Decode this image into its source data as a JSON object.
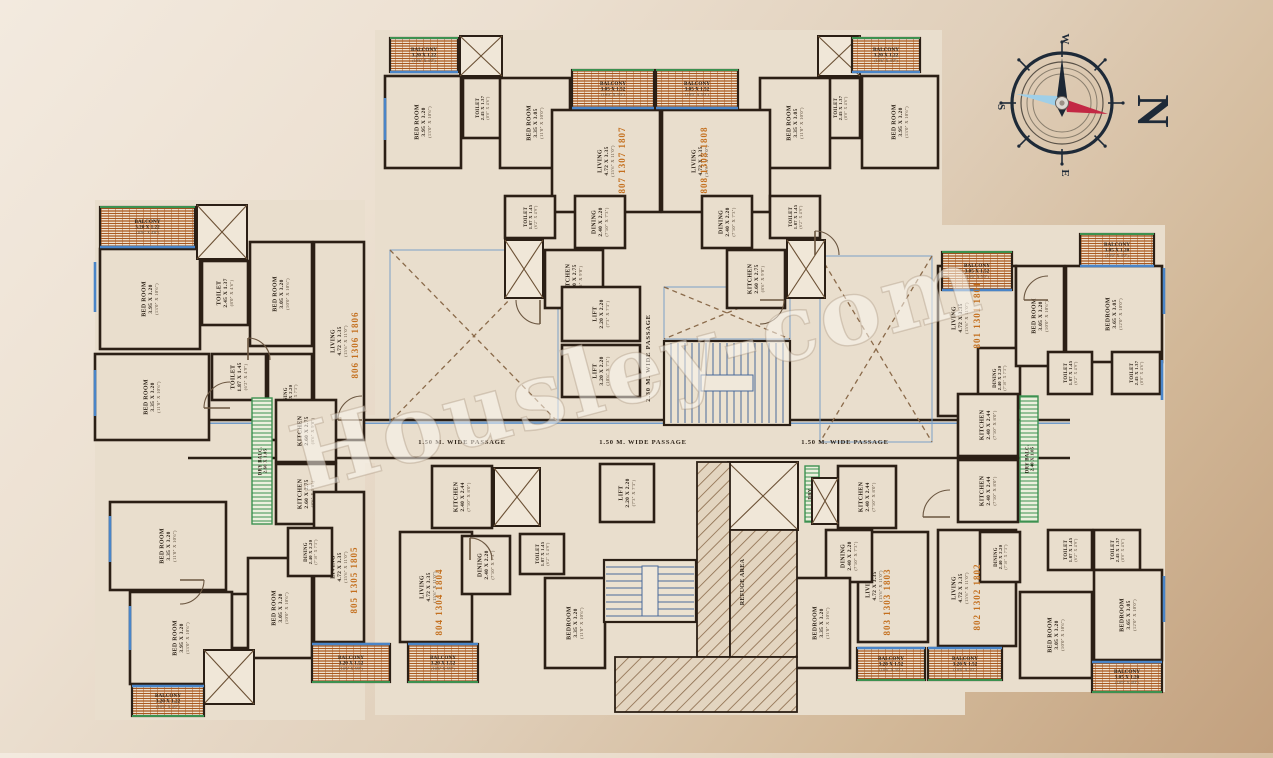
{
  "watermark": {
    "text": "Housley-com"
  },
  "compass": {
    "big_letter": "N",
    "letters": [
      {
        "t": "W",
        "x": 0,
        "y": -64
      },
      {
        "t": "S",
        "x": -64,
        "y": 4
      },
      {
        "t": "E",
        "x": 0,
        "y": 70
      }
    ],
    "colors": {
      "ring": "#1e2a38",
      "needle_dark": "#1c2734",
      "needle_red": "#c32844",
      "needle_blue": "#9fcfe8"
    }
  },
  "colors": {
    "wall": "#2b1f15",
    "interior": "#e9decd",
    "label": "#2e2318",
    "feet": "#5a4a38",
    "flat": "#c4701f",
    "window": "#4a85c8",
    "green": "#3c9150",
    "balcony_stripe": "#a9581f",
    "balcony_bg": "#f1e7d6",
    "door": "#6b5640",
    "tread": "#4a6a9a",
    "dash": "#8a6a4a"
  },
  "passages": [
    {
      "t": "1.50 M. WIDE PASSAGE",
      "x": 462,
      "y": 444,
      "rot": 0
    },
    {
      "t": "1.50 M. WIDE PASSAGE",
      "x": 643,
      "y": 444,
      "rot": 0
    },
    {
      "t": "1.50 M. WIDE PASSAGE",
      "x": 845,
      "y": 444,
      "rot": 0
    },
    {
      "t": "2.30 M. WIDE PASSAGE",
      "x": 650,
      "y": 358,
      "rot": -90
    }
  ],
  "refuge_label": {
    "t": "REFUGE AREA",
    "x": 742,
    "y": 582
  },
  "flats": [
    {
      "t": "807 1307 1807",
      "x": 625,
      "y": 160
    },
    {
      "t": "808 1308 1808",
      "x": 707,
      "y": 160
    },
    {
      "t": "806 1306 1806",
      "x": 358,
      "y": 345
    },
    {
      "t": "801 1301 1801",
      "x": 980,
      "y": 315
    },
    {
      "t": "805 1305 1805",
      "x": 357,
      "y": 580
    },
    {
      "t": "804 1304 1804",
      "x": 442,
      "y": 602
    },
    {
      "t": "803 1303 1803",
      "x": 890,
      "y": 602
    },
    {
      "t": "802 1302 1802",
      "x": 980,
      "y": 597
    }
  ],
  "silhouette": [
    [
      95,
      200,
      270,
      520
    ],
    [
      375,
      30,
      567,
      410
    ],
    [
      935,
      225,
      230,
      467
    ],
    [
      375,
      440,
      590,
      275
    ],
    [
      185,
      415,
      890,
      48
    ]
  ],
  "balconies": [
    {
      "x": 390,
      "y": 38,
      "w": 68,
      "h": 34,
      "l": [
        "BALCONY",
        "3.20 X 1.22",
        "(10'6\" X 4'0\")"
      ],
      "inner": "bottom"
    },
    {
      "x": 852,
      "y": 38,
      "w": 68,
      "h": 34,
      "l": [
        "BALCONY",
        "3.20 X 1.22",
        "(10'6\" X 4'0\")"
      ],
      "inner": "bottom"
    },
    {
      "x": 572,
      "y": 70,
      "w": 82,
      "h": 38,
      "l": [
        "BALCONY",
        "3.05 X 1.52",
        "(10'0\" X 5'0\")"
      ],
      "inner": "bottom"
    },
    {
      "x": 656,
      "y": 70,
      "w": 82,
      "h": 38,
      "l": [
        "BALCONY",
        "3.05 X 1.52",
        "(10'0\" X 5'0\")"
      ],
      "inner": "bottom"
    },
    {
      "x": 100,
      "y": 207,
      "w": 95,
      "h": 40,
      "l": [
        "BALCONY",
        "3.20 X 1.22",
        "(10'6\" X 4'0\")"
      ],
      "inner": "bottom"
    },
    {
      "x": 942,
      "y": 252,
      "w": 70,
      "h": 38,
      "l": [
        "BALCONY",
        "3.05 X 1.52",
        "(10'0\" X 5'0\")"
      ],
      "inner": "bottom"
    },
    {
      "x": 1080,
      "y": 234,
      "w": 74,
      "h": 32,
      "l": [
        "BALCONY",
        "3.05 X 1.20",
        "(10'0\" X 4'0\")"
      ],
      "inner": "bottom"
    },
    {
      "x": 132,
      "y": 686,
      "w": 72,
      "h": 30,
      "l": [
        "BALCONY",
        "3.20 X 1.22",
        "(10'6\" X 4'0\")"
      ],
      "inner": "top"
    },
    {
      "x": 312,
      "y": 644,
      "w": 78,
      "h": 38,
      "l": [
        "BALCONY",
        "3.20 X 1.52",
        "(10'6\" X 5'0\")"
      ],
      "inner": "top"
    },
    {
      "x": 408,
      "y": 644,
      "w": 70,
      "h": 38,
      "l": [
        "BALCONY",
        "3.20 X 1.52",
        "(10'6\" X 5'0\")"
      ],
      "inner": "top"
    },
    {
      "x": 857,
      "y": 648,
      "w": 68,
      "h": 32,
      "l": [
        "BALCONY",
        "3.20 X 1.52",
        "(10'6\" X 5'0\")"
      ],
      "inner": "top"
    },
    {
      "x": 928,
      "y": 648,
      "w": 74,
      "h": 32,
      "l": [
        "BALCONY",
        "3.20 X 1.52",
        "(10'6\" X 5'0\")"
      ],
      "inner": "top"
    },
    {
      "x": 1092,
      "y": 662,
      "w": 70,
      "h": 30,
      "l": [
        "BALCONY",
        "3.05 X 1.20",
        "(10'0\" X 4'0\")"
      ],
      "inner": "top"
    }
  ],
  "rooms": [
    {
      "x": 385,
      "y": 76,
      "w": 76,
      "h": 92,
      "l": [
        "BED ROOM",
        "3.95 X 3.20",
        "(13'0\" X 10'6\")"
      ]
    },
    {
      "x": 463,
      "y": 78,
      "w": 38,
      "h": 60,
      "l": [
        "TOILET",
        "2.45 X 1.37",
        "(8'0\" X 4'6\")"
      ]
    },
    {
      "x": 500,
      "y": 78,
      "w": 70,
      "h": 90,
      "l": [
        "BED ROOM",
        "3.35 X 3.05",
        "(11'0\" X 10'0\")"
      ]
    },
    {
      "x": 552,
      "y": 110,
      "w": 108,
      "h": 102,
      "l": [
        "LIVING",
        "4.72 X 3.35",
        "(15'6\" X 11'0\")"
      ],
      "lx": 606,
      "ly": 161
    },
    {
      "x": 575,
      "y": 196,
      "w": 50,
      "h": 52,
      "l": [
        "DINING",
        "2.40 X 2.20",
        "(7'10\" X 7'3\")"
      ]
    },
    {
      "x": 505,
      "y": 196,
      "w": 50,
      "h": 42,
      "l": [
        "TOILET",
        "1.87 X 1.45",
        "(6'2\" X 4'9\")"
      ]
    },
    {
      "x": 545,
      "y": 250,
      "w": 58,
      "h": 58,
      "l": [
        "KITCHEN",
        "2.60 X 2.75",
        "(8'6\" X 9'0\")"
      ]
    },
    {
      "x": 862,
      "y": 76,
      "w": 76,
      "h": 92,
      "l": [
        "BED ROOM",
        "3.95 X 3.20",
        "(13'0\" X 10'6\")"
      ]
    },
    {
      "x": 820,
      "y": 78,
      "w": 40,
      "h": 60,
      "l": [
        "TOILET",
        "2.45 X 1.37",
        "(8'0\" X 4'6\")"
      ]
    },
    {
      "x": 760,
      "y": 78,
      "w": 70,
      "h": 90,
      "l": [
        "BED ROOM",
        "3.35 X 3.05",
        "(11'0\" X 10'0\")"
      ]
    },
    {
      "x": 662,
      "y": 110,
      "w": 108,
      "h": 102,
      "l": [
        "LIVING",
        "4.72 X 3.35",
        "(15'6\" X 11'0\")"
      ],
      "lx": 700,
      "ly": 161
    },
    {
      "x": 702,
      "y": 196,
      "w": 50,
      "h": 52,
      "l": [
        "DINING",
        "2.40 X 2.20",
        "(7'10\" X 7'3\")"
      ]
    },
    {
      "x": 770,
      "y": 196,
      "w": 50,
      "h": 42,
      "l": [
        "TOILET",
        "1.87 X 1.45",
        "(6'2\" X 4'9\")"
      ]
    },
    {
      "x": 727,
      "y": 250,
      "w": 58,
      "h": 58,
      "l": [
        "KITCHEN",
        "2.60 X 2.75",
        "(8'6\" X 9'0\")"
      ]
    },
    {
      "x": 100,
      "y": 249,
      "w": 100,
      "h": 100,
      "l": [
        "BED ROOM",
        "3.95 X 3.20",
        "(13'0\" X 10'6\")"
      ]
    },
    {
      "x": 202,
      "y": 261,
      "w": 46,
      "h": 64,
      "l": [
        "TOILET",
        "2.45 X 1.37",
        "(8'0\" X 4'6\")"
      ]
    },
    {
      "x": 250,
      "y": 242,
      "w": 62,
      "h": 104,
      "l": [
        "BED ROOM",
        "3.05 X 3.20",
        "(10'0\" X 10'6\")"
      ]
    },
    {
      "x": 95,
      "y": 354,
      "w": 114,
      "h": 86,
      "l": [
        "BED ROOM",
        "3.35 X 3.20",
        "(11'0\" X 10'6\")"
      ]
    },
    {
      "x": 212,
      "y": 354,
      "w": 54,
      "h": 46,
      "l": [
        "TOILET",
        "1.87 X 1.45",
        "(6'2\" X 4'9\")"
      ]
    },
    {
      "x": 314,
      "y": 242,
      "w": 50,
      "h": 198,
      "l": [
        "LIVING",
        "4.72 X 3.35",
        "(15'6\" X 11'0\")"
      ],
      "lx": 339,
      "ly": 341
    },
    {
      "x": 268,
      "y": 354,
      "w": 44,
      "h": 86,
      "l": [
        "DINING",
        "2.40 X 2.20",
        "(7'10\" X 7'3\")"
      ]
    },
    {
      "x": 276,
      "y": 400,
      "w": 60,
      "h": 62,
      "l": [
        "KITCHEN",
        "2.60 X 2.75",
        "(8'6\" X 9'0\")"
      ]
    },
    {
      "x": 276,
      "y": 464,
      "w": 60,
      "h": 60,
      "l": [
        "KITCHEN",
        "2.60 X 2.75",
        "(8'6\" X 9'0\")"
      ]
    },
    {
      "x": 110,
      "y": 502,
      "w": 116,
      "h": 88,
      "l": [
        "BED ROOM",
        "3.35 X 3.20",
        "(11'0\" X 10'6\")"
      ]
    },
    {
      "x": 130,
      "y": 592,
      "w": 102,
      "h": 92,
      "l": [
        "BED ROOM",
        "3.95 X 3.20",
        "(13'0\" X 10'6\")"
      ]
    },
    {
      "x": 232,
      "y": 594,
      "w": 48,
      "h": 54,
      "l": [
        "TOILET",
        "2.45 X 1.37",
        "(8'0\" X 4'6\")"
      ]
    },
    {
      "x": 248,
      "y": 558,
      "w": 64,
      "h": 100,
      "l": [
        "BED ROOM",
        "3.05 X 3.20",
        "(10'0\" X 10'6\")"
      ]
    },
    {
      "x": 314,
      "y": 492,
      "w": 50,
      "h": 150,
      "l": [
        "LIVING",
        "4.72 X 3.35",
        "(15'6\" X 11'0\")"
      ],
      "lx": 339,
      "ly": 567
    },
    {
      "x": 288,
      "y": 528,
      "w": 44,
      "h": 48,
      "l": [
        "DINING",
        "2.40 X 2.20",
        "(7'10\" X 7'3\")"
      ]
    },
    {
      "x": 432,
      "y": 466,
      "w": 60,
      "h": 62,
      "l": [
        "KITCHEN",
        "2.40 X 2.44",
        "(7'10\" X 8'0\")"
      ]
    },
    {
      "x": 400,
      "y": 532,
      "w": 72,
      "h": 110,
      "l": [
        "LIVING",
        "4.72 X 3.35",
        "(15'6\" X 11'0\")"
      ],
      "lx": 428,
      "ly": 587
    },
    {
      "x": 462,
      "y": 536,
      "w": 48,
      "h": 58,
      "l": [
        "DINING",
        "2.40 X 2.20",
        "(7'10\" X 7'3\")"
      ]
    },
    {
      "x": 520,
      "y": 534,
      "w": 44,
      "h": 40,
      "l": [
        "TOILET",
        "1.87 X 1.45",
        "(6'2\" X 4'9\")"
      ]
    },
    {
      "x": 545,
      "y": 578,
      "w": 60,
      "h": 90,
      "l": [
        "BEDROOM",
        "3.35 X 3.20",
        "(11'0\" X 10'6\")"
      ]
    },
    {
      "x": 838,
      "y": 466,
      "w": 58,
      "h": 62,
      "l": [
        "KITCHEN",
        "2.40 X 2.44",
        "(7'10\" X 8'0\")"
      ]
    },
    {
      "x": 858,
      "y": 532,
      "w": 70,
      "h": 110,
      "l": [
        "LIVING",
        "4.72 X 3.35",
        "(15'6\" X 11'0\")"
      ],
      "lx": 874,
      "ly": 586
    },
    {
      "x": 826,
      "y": 530,
      "w": 46,
      "h": 52,
      "l": [
        "DINING",
        "2.40 X 2.20",
        "(7'10\" X 7'3\")"
      ]
    },
    {
      "x": 792,
      "y": 578,
      "w": 58,
      "h": 90,
      "l": [
        "BEDROOM",
        "3.35 X 3.20",
        "(11'0\" X 10'6\")"
      ]
    },
    {
      "x": 938,
      "y": 266,
      "w": 78,
      "h": 150,
      "l": [
        "LIVING",
        "4.72 X 3.35",
        "(15'6\" X 11'0\")"
      ],
      "lx": 960,
      "ly": 318
    },
    {
      "x": 978,
      "y": 348,
      "w": 42,
      "h": 60,
      "l": [
        "DINING",
        "2.40 X 2.20",
        "(7'10\" X 7'3\")"
      ]
    },
    {
      "x": 1016,
      "y": 266,
      "w": 48,
      "h": 100,
      "l": [
        "BED ROOM",
        "3.05 X 3.20",
        "(10'0\" X 10'6\")"
      ]
    },
    {
      "x": 1066,
      "y": 266,
      "w": 96,
      "h": 96,
      "l": [
        "BEDROOM",
        "3.65 X 3.05",
        "(12'0\" X 10'0\")"
      ]
    },
    {
      "x": 1048,
      "y": 352,
      "w": 44,
      "h": 42,
      "l": [
        "TOILET",
        "1.87 X 1.45",
        "(6'2\" X 4'9\")"
      ]
    },
    {
      "x": 1112,
      "y": 352,
      "w": 48,
      "h": 42,
      "l": [
        "TOILET",
        "2.45 X 1.37",
        "(8'0\" X 4'6\")"
      ]
    },
    {
      "x": 958,
      "y": 394,
      "w": 60,
      "h": 62,
      "l": [
        "KITCHEN",
        "2.40 X 2.44",
        "(7'10\" X 8'0\")"
      ]
    },
    {
      "x": 958,
      "y": 460,
      "w": 60,
      "h": 62,
      "l": [
        "KITCHEN",
        "2.40 X 2.44",
        "(7'10\" X 8'0\")"
      ]
    },
    {
      "x": 938,
      "y": 530,
      "w": 78,
      "h": 116,
      "l": [
        "LIVING",
        "4.72 X 3.35",
        "(15'6\" X 11'0\")"
      ],
      "lx": 960,
      "ly": 588
    },
    {
      "x": 980,
      "y": 532,
      "w": 40,
      "h": 50,
      "l": [
        "DINING",
        "2.40 X 2.20",
        "(7'10\" X 7'3\")"
      ]
    },
    {
      "x": 1048,
      "y": 530,
      "w": 44,
      "h": 40,
      "l": [
        "TOILET",
        "1.87 X 1.45",
        "(6'2\" X 4'9\")"
      ]
    },
    {
      "x": 1094,
      "y": 530,
      "w": 46,
      "h": 40,
      "l": [
        "TOILET",
        "2.45 X 1.37",
        "(8'0\" X 4'6\")"
      ]
    },
    {
      "x": 1020,
      "y": 592,
      "w": 72,
      "h": 86,
      "l": [
        "BED ROOM",
        "3.05 X 3.20",
        "(10'0\" X 10'6\")"
      ]
    },
    {
      "x": 1094,
      "y": 570,
      "w": 68,
      "h": 90,
      "l": [
        "BEDROOM",
        "3.65 X 3.05",
        "(12'0\" X 10'0\")"
      ]
    },
    {
      "x": 562,
      "y": 287,
      "w": 78,
      "h": 54,
      "l": [
        "LIFT",
        "2.20 X 2.20",
        "(7'3\" X 7'3\")"
      ]
    },
    {
      "x": 562,
      "y": 345,
      "w": 78,
      "h": 52,
      "l": [
        "LIFT",
        "3.20 X 2.20",
        "(10'6\" X 7'3\")"
      ]
    },
    {
      "x": 600,
      "y": 464,
      "w": 54,
      "h": 58,
      "l": [
        "LIFT",
        "2.20 X 2.20",
        "(7'3\" X 7'3\")"
      ]
    }
  ],
  "xducts": [
    [
      460,
      36,
      42,
      40
    ],
    [
      818,
      36,
      42,
      40
    ],
    [
      197,
      205,
      50,
      54
    ],
    [
      204,
      650,
      50,
      54
    ],
    [
      494,
      468,
      46,
      58
    ],
    [
      812,
      478,
      26,
      46
    ],
    [
      728,
      462,
      70,
      68
    ],
    [
      505,
      240,
      38,
      58
    ],
    [
      787,
      240,
      38,
      58
    ]
  ],
  "xvoids": [
    [
      390,
      250,
      168,
      172
    ],
    [
      820,
      256,
      112,
      186
    ],
    [
      664,
      287,
      126,
      52
    ]
  ],
  "stairs": [
    {
      "x": 664,
      "y": 341,
      "w": 126,
      "h": 84,
      "dir": "v"
    },
    {
      "x": 604,
      "y": 560,
      "w": 92,
      "h": 62,
      "dir": "h"
    }
  ],
  "drybalcs": [
    {
      "x": 252,
      "y": 398,
      "w": 20,
      "h": 126,
      "l": [
        "DRY BALC.",
        "2.60 X 1.05"
      ]
    },
    {
      "x": 518,
      "y": 468,
      "w": 14,
      "h": 56,
      "l": [
        "DRY",
        "BALC."
      ]
    },
    {
      "x": 805,
      "y": 466,
      "w": 14,
      "h": 56,
      "l": [
        "DRY",
        "BALC."
      ]
    },
    {
      "x": 1020,
      "y": 396,
      "w": 18,
      "h": 126,
      "l": [
        "DRY BALC.",
        "2.40 X 1.05"
      ]
    }
  ],
  "refuge": [
    [
      697,
      462,
      33,
      195
    ],
    [
      730,
      530,
      67,
      127
    ],
    [
      615,
      657,
      182,
      55
    ]
  ],
  "corridor": {
    "x1": 188,
    "x2": 1070,
    "ytop": 420,
    "ybot": 458
  },
  "windows": [
    [
      95,
      262,
      95,
      312
    ],
    [
      95,
      370,
      95,
      416
    ],
    [
      110,
      516,
      110,
      562
    ],
    [
      130,
      606,
      130,
      650
    ],
    [
      1164,
      268,
      1164,
      314
    ],
    [
      1164,
      576,
      1164,
      622
    ],
    [
      385,
      98,
      385,
      140
    ],
    [
      1162,
      360,
      1162,
      400
    ]
  ],
  "doors": [
    [
      362,
      420,
      24,
      180,
      270
    ],
    [
      230,
      408,
      26,
      180,
      270
    ],
    [
      950,
      517,
      27,
      180,
      270
    ],
    [
      248,
      360,
      22,
      270,
      360
    ],
    [
      540,
      300,
      24,
      90,
      180
    ],
    [
      760,
      300,
      24,
      0,
      90
    ],
    [
      1048,
      300,
      24,
      180,
      270
    ],
    [
      470,
      560,
      22,
      270,
      360
    ],
    [
      815,
      255,
      24,
      270,
      360
    ],
    [
      180,
      580,
      24,
      0,
      90
    ]
  ]
}
